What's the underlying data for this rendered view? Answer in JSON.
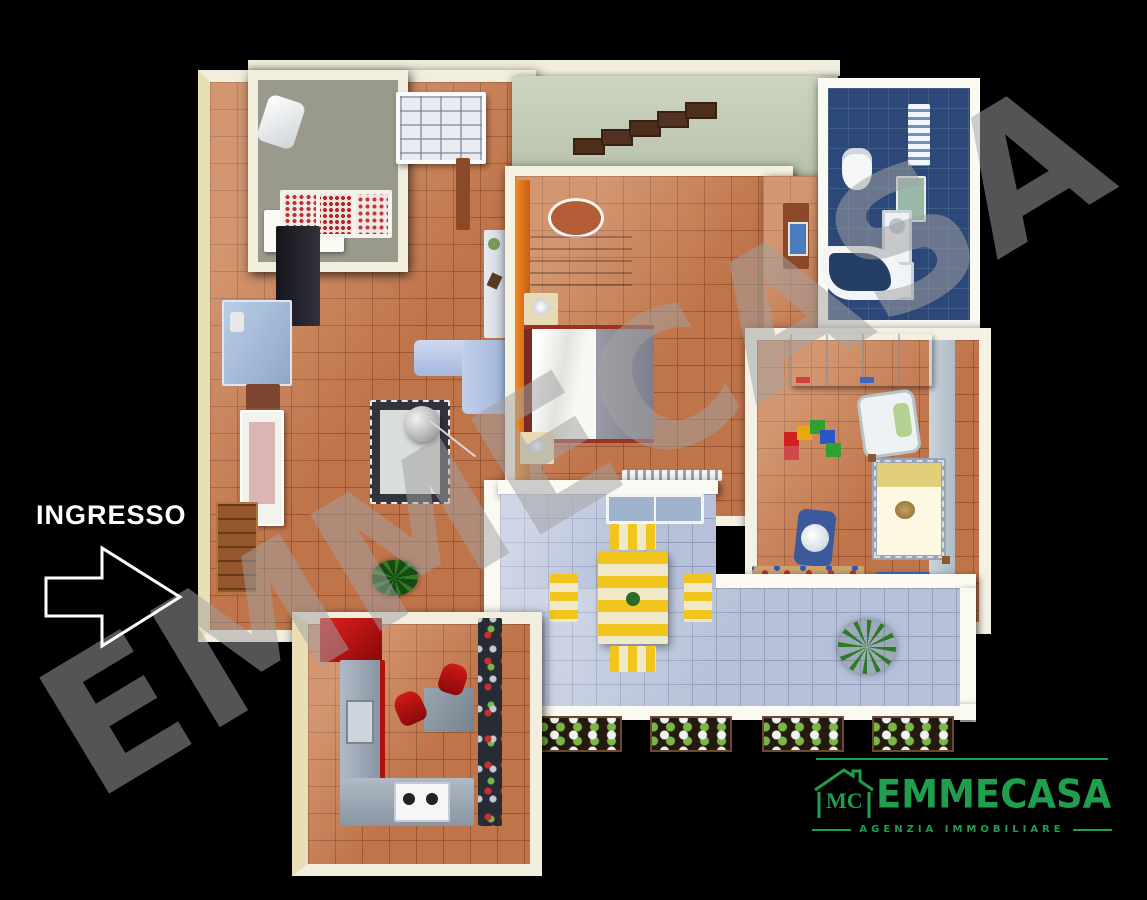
{
  "scene": {
    "background": "#000000",
    "entrance_label": "INGRESSO",
    "watermark_text": "EMMECASA"
  },
  "logo": {
    "monogram": "MC",
    "brand": "EMMECASA",
    "tagline": "AGENZIA IMMOBILIARE",
    "color": "#1f9e4e"
  },
  "colors": {
    "wall_cream": "#f2eedd",
    "floor_terracotta": "#c0744a",
    "floor_terrace": "#b6c1d9",
    "bathroom_wall_blue": "#3a63b4",
    "bathroom_floor_blue": "#2c4878",
    "kitchen_red": "#c01414",
    "sofa_blue": "#b3c4e6",
    "terrace_table_yellow": "#f2c51d",
    "wardrobe_orange": "#e27a1e"
  }
}
